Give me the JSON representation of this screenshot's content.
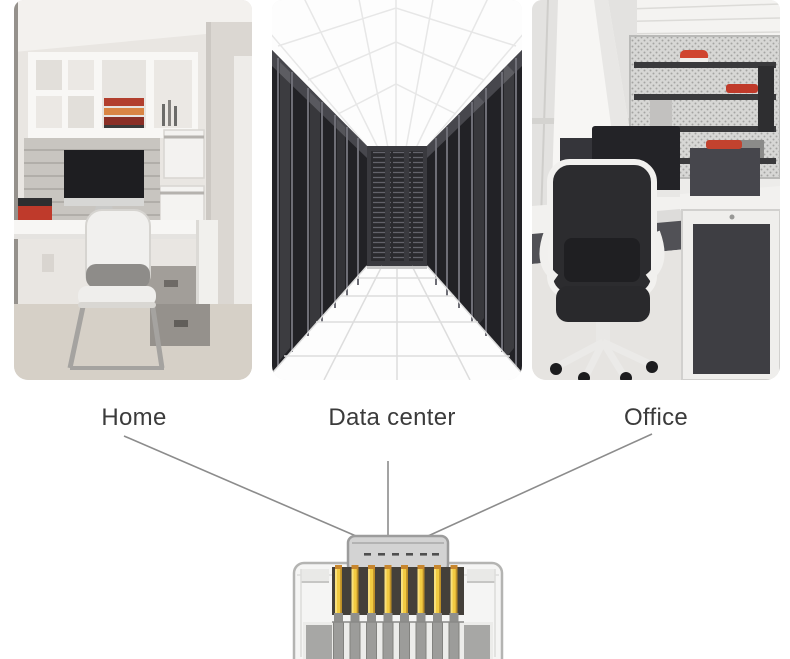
{
  "section": {
    "name": "application-scenarios",
    "background": "#ffffff"
  },
  "scenes": [
    {
      "id": "home",
      "label": "Home",
      "image": "home-office-photo"
    },
    {
      "id": "data_center",
      "label": "Data center",
      "image": "data-center-server-room-photo"
    },
    {
      "id": "office",
      "label": "Office",
      "image": "open-plan-office-photo"
    }
  ],
  "connector": {
    "name": "RJ45 ethernet plug",
    "pin_count": 8
  },
  "colors": {
    "label_text": "#3b3b3b",
    "connector_line": "#8c8c8c",
    "pin_gold": "#f2cb42",
    "plug_body": "#f5f5f4",
    "latch_cap": "#d3d3d3"
  }
}
